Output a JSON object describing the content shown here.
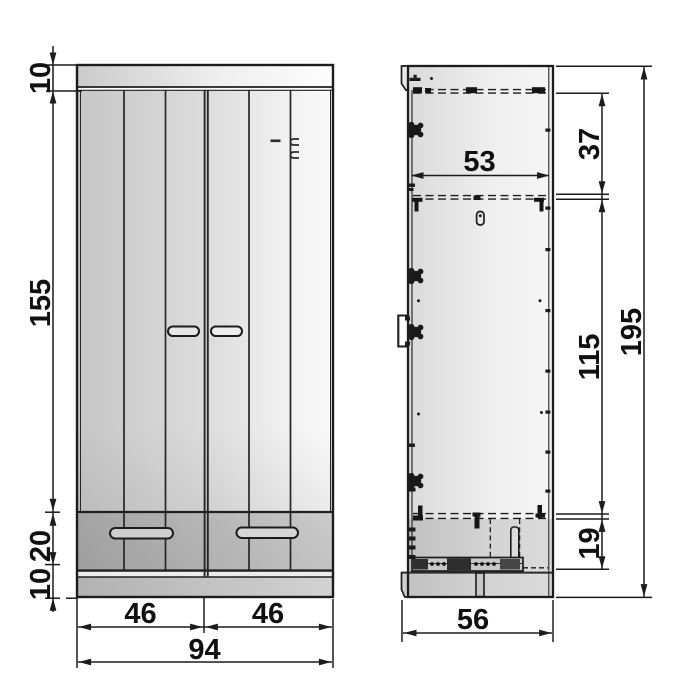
{
  "document": {
    "type": "furniture-dimension-drawing",
    "subject": "two-door wardrobe with drawers, front and side views"
  },
  "dimensions": {
    "front_view": {
      "top_panel_height": "10",
      "door_height": "155",
      "drawer_front_height": "20",
      "plinth_height": "10",
      "left_door_width": "46",
      "right_door_width": "46",
      "overall_width": "94"
    },
    "side_view": {
      "interior_depth": "53",
      "upper_compartment_height": "37",
      "main_compartment_height": "115",
      "drawer_compartment_height": "19",
      "overall_height": "195",
      "overall_depth": "56"
    }
  },
  "colors": {
    "background": "#ffffff",
    "line": "#1c1c1c",
    "panel_dark": "#b0b0b0",
    "panel_mid": "#d8d8d8",
    "panel_light": "#f6f6f6"
  }
}
